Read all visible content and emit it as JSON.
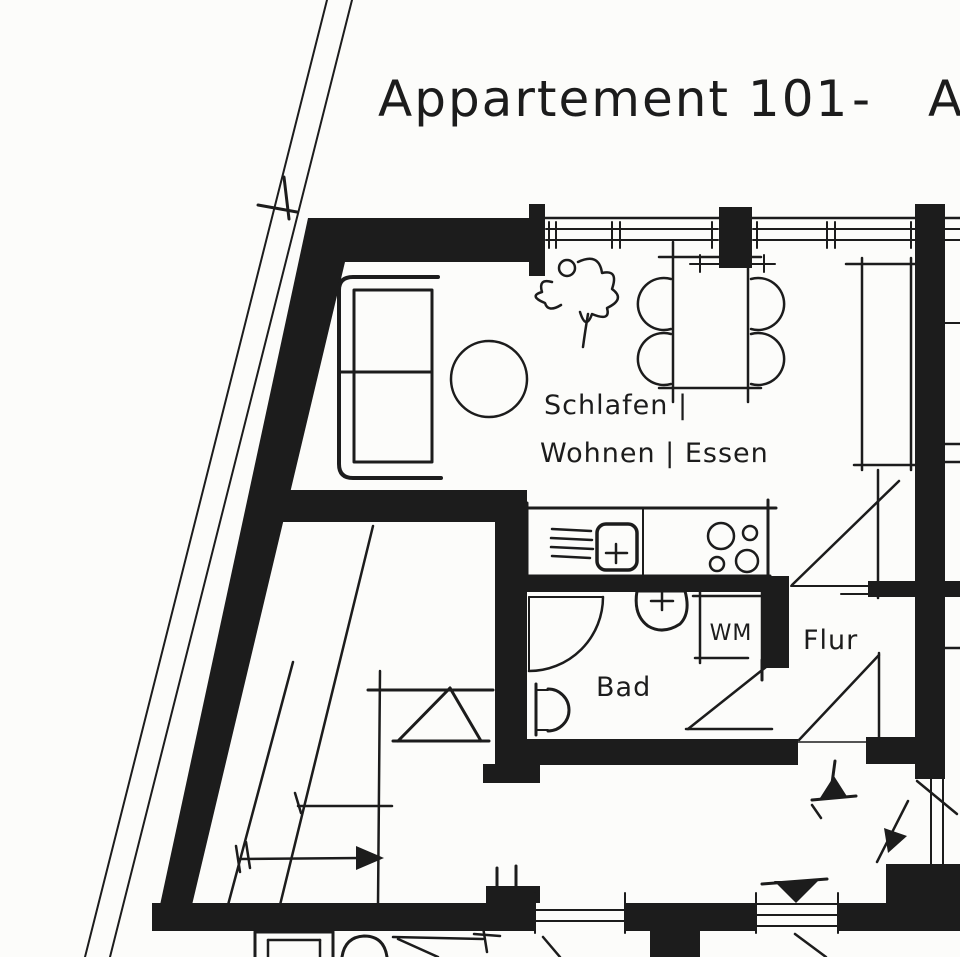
{
  "meta": {
    "paper_color": "#fcfcfa",
    "ink_color": "#1c1c1c",
    "drawing_style": "hand-drawn scanned floor plan"
  },
  "title": {
    "main": "Appartement 101",
    "dash": "-",
    "suffix": "A"
  },
  "labels": {
    "living_line1": "Schlafen |",
    "living_line2": "Wohnen | Essen",
    "bath": "Bad",
    "hall": "Flur",
    "washing_machine": "WM"
  }
}
